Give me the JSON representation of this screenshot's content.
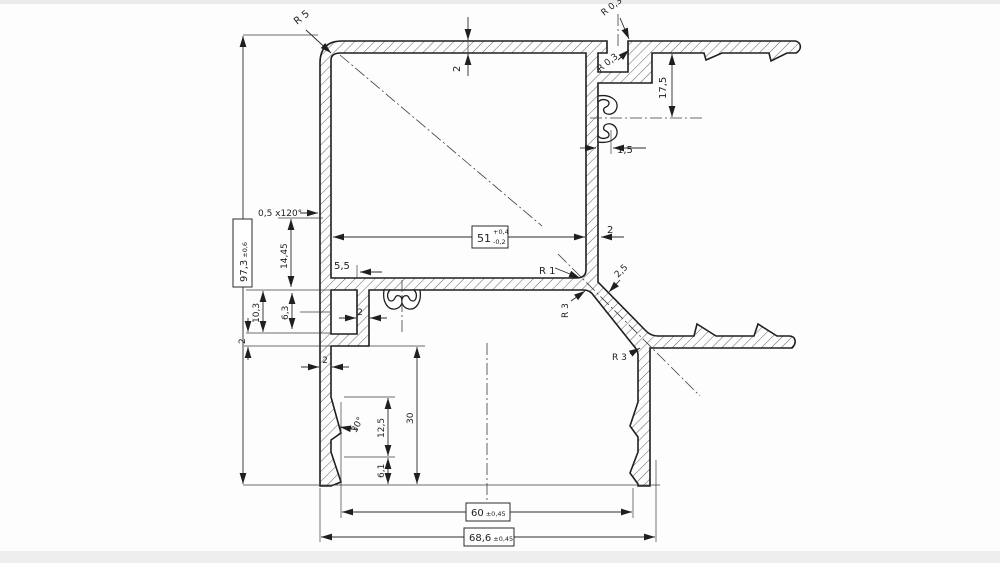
{
  "title": "Aluminium profile cross-section technical drawing",
  "colors": {
    "ink": "#1f1f1f",
    "background": "#fdfdfd",
    "scan_band": "#dcdcdc"
  },
  "labels": {
    "r5": "R 5",
    "r03": "R 0,3",
    "two": "2",
    "d175": "17,5",
    "d15": "1,5",
    "chamfer": "0,5 x120°",
    "d97": {
      "v": "97,3",
      "tol": "±0,6"
    },
    "d1445": "14,45",
    "d55": "5,5",
    "d51": {
      "v": "51",
      "tol_plus": "+0,4",
      "tol_minus": "-0,2"
    },
    "r1": "R 1",
    "d25": "2,5",
    "r3": "R 3",
    "d103": "10,3",
    "d63": "6,3",
    "d30": "30",
    "a30": "30°",
    "d125": "12,5",
    "d61": "6,1",
    "d60": {
      "v": "60",
      "tol": "±0,45"
    },
    "d686": {
      "v": "68,6",
      "tol": "±0,45"
    }
  }
}
